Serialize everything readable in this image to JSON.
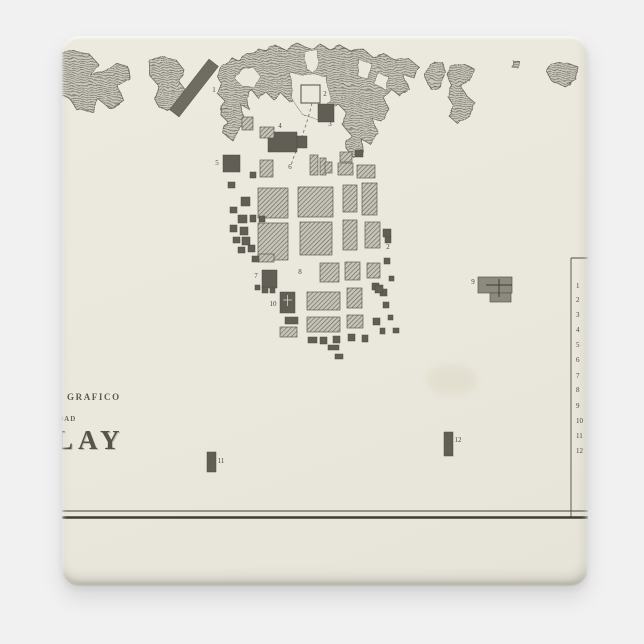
{
  "product": {
    "background_color": "#f1f1f2",
    "magnet_face_color": "#eae8dd"
  },
  "map": {
    "colors": {
      "paper": "#eae8dd",
      "ink_dark": "#5f5c53",
      "ink_line": "#6b685f",
      "label": "#4a463f",
      "block_dark": "#615e55",
      "block_hatch_bg": "#c6c4b8",
      "block_hatch_line": "#6b685f",
      "pier": "#6f6c62",
      "feature9_fill": "#8c897f",
      "rule": "#3f3c36"
    },
    "title": {
      "line1": "GRAFICO",
      "line2": "DAD",
      "line3": "LAY"
    },
    "coast": {
      "blobs": [
        "-8,18 14,15 28,19 36,28 30,40 42,36 54,27 66,31 68,43 56,50 60,63 47,72 36,63 30,75 15,74 7,62 -8,58",
        "88,26 102,20 114,24 122,34 118,46 124,56 118,70 108,77 98,72 92,62 95,48 88,40",
        "155,40 160,28 170,22 178,26 186,18 196,12 206,16 214,10 224,14 236,8 248,12 258,8 268,14 278,10 290,16 300,12 310,20 322,18 334,24 346,22 356,30 352,42 342,40 348,54 338,60 328,52 322,62 328,74 320,86 310,82 316,96 308,108 298,102 302,116 292,122 284,112 288,98 280,88 284,76 276,68 268,74 262,64 252,58 244,66 236,60 228,66 220,58 212,64 204,56 196,62 190,54 184,62 188,74 180,70 184,86 176,96 170,104 162,98 166,86 158,78 164,66 156,58 160,48",
        "368,28 379,25 384,37 378,50 368,52 363,40",
        "388,30 401,27 412,33 408,45 398,50 404,59 412,66 408,79 396,88 387,80 392,70 386,61 390,50 386,40",
        "490,28 503,25 516,31 514,43 502,50 491,46 485,36",
        "450,24 457,25 456,32 449,30"
      ],
      "inlets": [
        "176,34 190,30 198,40 192,52 180,50 172,42",
        "244,16 254,12 258,26 252,38 244,32 242,22",
        "230,38 264,40 268,64 258,84 240,78 228,60",
        "298,24 310,28 306,44 296,40",
        "316,36 326,40 322,52 312,48"
      ]
    },
    "pier": {
      "cx": 132,
      "cy": 52,
      "w": 12,
      "l": 64,
      "angle": 38,
      "label": "1",
      "lx": 152,
      "ly": 56
    },
    "harbor_square": {
      "x": 239,
      "y": 49,
      "w": 19,
      "h": 18,
      "label": "2",
      "lx": 263,
      "ly": 60
    },
    "road": {
      "d": "M250,67 C246,84 241,98 237,108 C233,118 231,122 229,130",
      "dash": "3 2.6"
    },
    "blocks": [
      [
        256,
        68,
        16,
        18,
        "d"
      ],
      [
        206,
        96,
        29,
        20,
        "d"
      ],
      [
        235,
        100,
        10,
        12,
        "d"
      ],
      [
        198,
        91,
        14,
        11,
        "h"
      ],
      [
        180,
        81,
        11,
        13,
        "h"
      ],
      [
        161,
        119,
        17,
        17,
        "d"
      ],
      [
        198,
        124,
        13,
        17,
        "h"
      ],
      [
        248,
        119,
        8,
        20,
        "h"
      ],
      [
        258,
        122,
        6,
        17,
        "h"
      ],
      [
        263,
        126,
        7,
        11,
        "h"
      ],
      [
        278,
        116,
        12,
        10,
        "h"
      ],
      [
        293,
        114,
        8,
        7,
        "d"
      ],
      [
        276,
        127,
        15,
        12,
        "h"
      ],
      [
        295,
        129,
        18,
        13,
        "h"
      ],
      [
        188,
        136,
        6,
        6,
        "d"
      ],
      [
        196,
        152,
        30,
        30,
        "h"
      ],
      [
        236,
        151,
        35,
        30,
        "h"
      ],
      [
        281,
        149,
        14,
        27,
        "h"
      ],
      [
        300,
        147,
        15,
        32,
        "h"
      ],
      [
        196,
        187,
        30,
        37,
        "h"
      ],
      [
        196,
        218,
        16,
        8,
        "h"
      ],
      [
        238,
        186,
        32,
        33,
        "h"
      ],
      [
        281,
        184,
        14,
        30,
        "h"
      ],
      [
        303,
        186,
        15,
        26,
        "h"
      ],
      [
        321,
        193,
        8,
        8,
        "d"
      ],
      [
        258,
        227,
        19,
        19,
        "h"
      ],
      [
        283,
        226,
        15,
        18,
        "h"
      ],
      [
        305,
        227,
        13,
        15,
        "h"
      ],
      [
        322,
        222,
        6,
        6,
        "d"
      ],
      [
        200,
        234,
        15,
        18,
        "d"
      ],
      [
        245,
        256,
        33,
        18,
        "h"
      ],
      [
        285,
        252,
        15,
        20,
        "h"
      ],
      [
        310,
        247,
        7,
        7,
        "d"
      ],
      [
        318,
        253,
        7,
        7,
        "d"
      ],
      [
        218,
        256,
        15,
        21,
        "d"
      ],
      [
        223,
        281,
        13,
        7,
        "d"
      ],
      [
        245,
        281,
        33,
        15,
        "h"
      ],
      [
        285,
        279,
        16,
        13,
        "h"
      ],
      [
        218,
        291,
        17,
        10,
        "h"
      ],
      [
        311,
        282,
        7,
        7,
        "d"
      ],
      [
        318,
        292,
        5,
        6,
        "d"
      ],
      [
        246,
        301,
        9,
        6,
        "d"
      ],
      [
        258,
        301,
        7,
        7,
        "d"
      ],
      [
        271,
        300,
        7,
        7,
        "d"
      ],
      [
        286,
        298,
        7,
        7,
        "d"
      ],
      [
        300,
        299,
        6,
        7,
        "d"
      ],
      [
        266,
        309,
        11,
        5,
        "d"
      ],
      [
        273,
        318,
        8,
        5,
        "d"
      ],
      [
        166,
        146,
        7,
        6,
        "d"
      ],
      [
        179,
        161,
        9,
        9,
        "d"
      ],
      [
        168,
        171,
        7,
        6,
        "d"
      ],
      [
        176,
        179,
        9,
        8,
        "d"
      ],
      [
        188,
        179,
        6,
        7,
        "d"
      ],
      [
        168,
        189,
        7,
        7,
        "d"
      ],
      [
        178,
        191,
        8,
        8,
        "d"
      ],
      [
        171,
        201,
        7,
        6,
        "d"
      ],
      [
        180,
        201,
        8,
        8,
        "d"
      ],
      [
        176,
        211,
        7,
        6,
        "d"
      ],
      [
        186,
        209,
        7,
        7,
        "d"
      ],
      [
        190,
        220,
        7,
        6,
        "d"
      ],
      [
        197,
        180,
        6,
        6,
        "d"
      ],
      [
        193,
        249,
        5,
        5,
        "d"
      ],
      [
        200,
        251,
        6,
        6,
        "d"
      ],
      [
        208,
        252,
        5,
        5,
        "d"
      ],
      [
        323,
        201,
        6,
        6,
        "d"
      ],
      [
        313,
        249,
        8,
        8,
        "d"
      ],
      [
        327,
        240,
        5,
        5,
        "d"
      ],
      [
        321,
        266,
        6,
        6,
        "d"
      ],
      [
        326,
        279,
        5,
        5,
        "d"
      ],
      [
        331,
        292,
        6,
        5,
        "d"
      ],
      [
        145,
        416,
        9,
        20,
        "d"
      ],
      [
        382,
        396,
        9,
        24,
        "d"
      ]
    ],
    "feature9": {
      "rects": [
        [
          416,
          241,
          34,
          16
        ],
        [
          428,
          257,
          21,
          9
        ]
      ],
      "cross": {
        "h": [
          424,
          249,
          450
        ],
        "v": [
          437,
          243,
          261
        ]
      },
      "label": "9",
      "lx": 411,
      "ly": 248
    },
    "church_cross": {
      "h": [
        221,
        264,
        230
      ],
      "v": [
        225.5,
        259,
        270
      ]
    },
    "labels": [
      {
        "n": "3",
        "x": 268,
        "y": 90
      },
      {
        "n": "4",
        "x": 218,
        "y": 92
      },
      {
        "n": "5",
        "x": 155,
        "y": 129
      },
      {
        "n": "6",
        "x": 228,
        "y": 133
      },
      {
        "n": "7",
        "x": 194,
        "y": 242
      },
      {
        "n": "8",
        "x": 238,
        "y": 238
      },
      {
        "n": "10",
        "x": 211,
        "y": 270
      },
      {
        "n": "11",
        "x": 159,
        "y": 427
      },
      {
        "n": "12",
        "x": 396,
        "y": 406
      },
      {
        "n": "2",
        "x": 326,
        "y": 213
      }
    ],
    "legend": {
      "line_x": 509,
      "top": 222,
      "bottom": 481,
      "tick_x2": 526,
      "num_x": 514,
      "items": [
        {
          "n": "1",
          "y": 252
        },
        {
          "n": "2",
          "y": 266
        },
        {
          "n": "3",
          "y": 281
        },
        {
          "n": "4",
          "y": 296
        },
        {
          "n": "5",
          "y": 311
        },
        {
          "n": "6",
          "y": 326
        },
        {
          "n": "7",
          "y": 342
        },
        {
          "n": "8",
          "y": 356
        },
        {
          "n": "9",
          "y": 372
        },
        {
          "n": "10",
          "y": 387
        },
        {
          "n": "11",
          "y": 402
        },
        {
          "n": "12",
          "y": 417
        }
      ]
    },
    "rules": [
      {
        "y": 475,
        "w": 0.9
      },
      {
        "y": 481.5,
        "w": 2.6
      }
    ],
    "stain": {
      "cx": 390,
      "cy": 344,
      "rx": 26,
      "ry": 16
    }
  }
}
